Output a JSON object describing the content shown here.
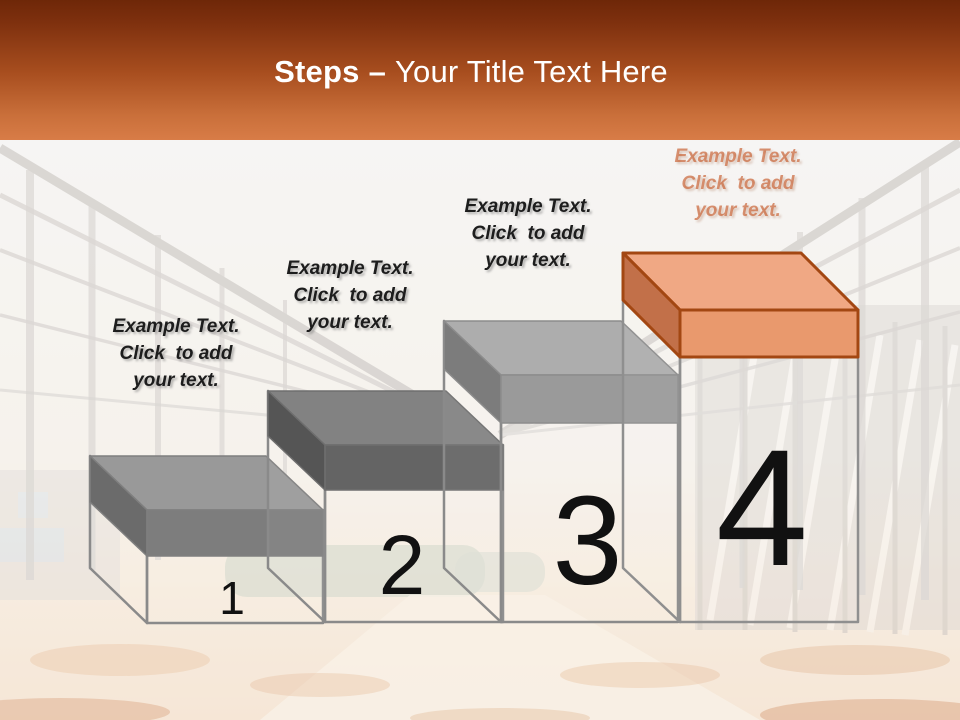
{
  "title": {
    "bold": "Steps",
    "dash": "–",
    "rest": "Your Title Text Here"
  },
  "header_colors": {
    "gradient_top": "#6E2708",
    "gradient_bottom": "#D87C47",
    "text": "#FFFFFF"
  },
  "numbers_color": "#111111",
  "steps": [
    {
      "number": "1",
      "label_lines": [
        "Example Text.",
        "Click  to add",
        "your text."
      ],
      "colors": {
        "top": "#999999",
        "front": "#7D7D7D",
        "side": "#6B6B6B",
        "cap_outline": "#7F7F7F",
        "body_outline": "#8A8A8A"
      }
    },
    {
      "number": "2",
      "label_lines": [
        "Example Text.",
        "Click  to add",
        "your text."
      ],
      "colors": {
        "top": "#828282",
        "front": "#646464",
        "side": "#555555",
        "cap_outline": "#6E6E6E",
        "body_outline": "#8A8A8A"
      }
    },
    {
      "number": "3",
      "label_lines": [
        "Example Text.",
        "Click  to add",
        "your text."
      ],
      "colors": {
        "top": "#ADADAD",
        "front": "#9A9A9A",
        "side": "#7C7C7C",
        "cap_outline": "#8C8C8C",
        "body_outline": "#8A8A8A"
      }
    },
    {
      "number": "4",
      "label_lines": [
        "Example Text.",
        "Click  to add",
        "your text."
      ],
      "label_color": "#C65A2B",
      "colors": {
        "top": "#F0A884",
        "front": "#E9996D",
        "side": "#C27049",
        "cap_outline": "#A34712",
        "body_outline": "#8F8F8F"
      }
    }
  ]
}
